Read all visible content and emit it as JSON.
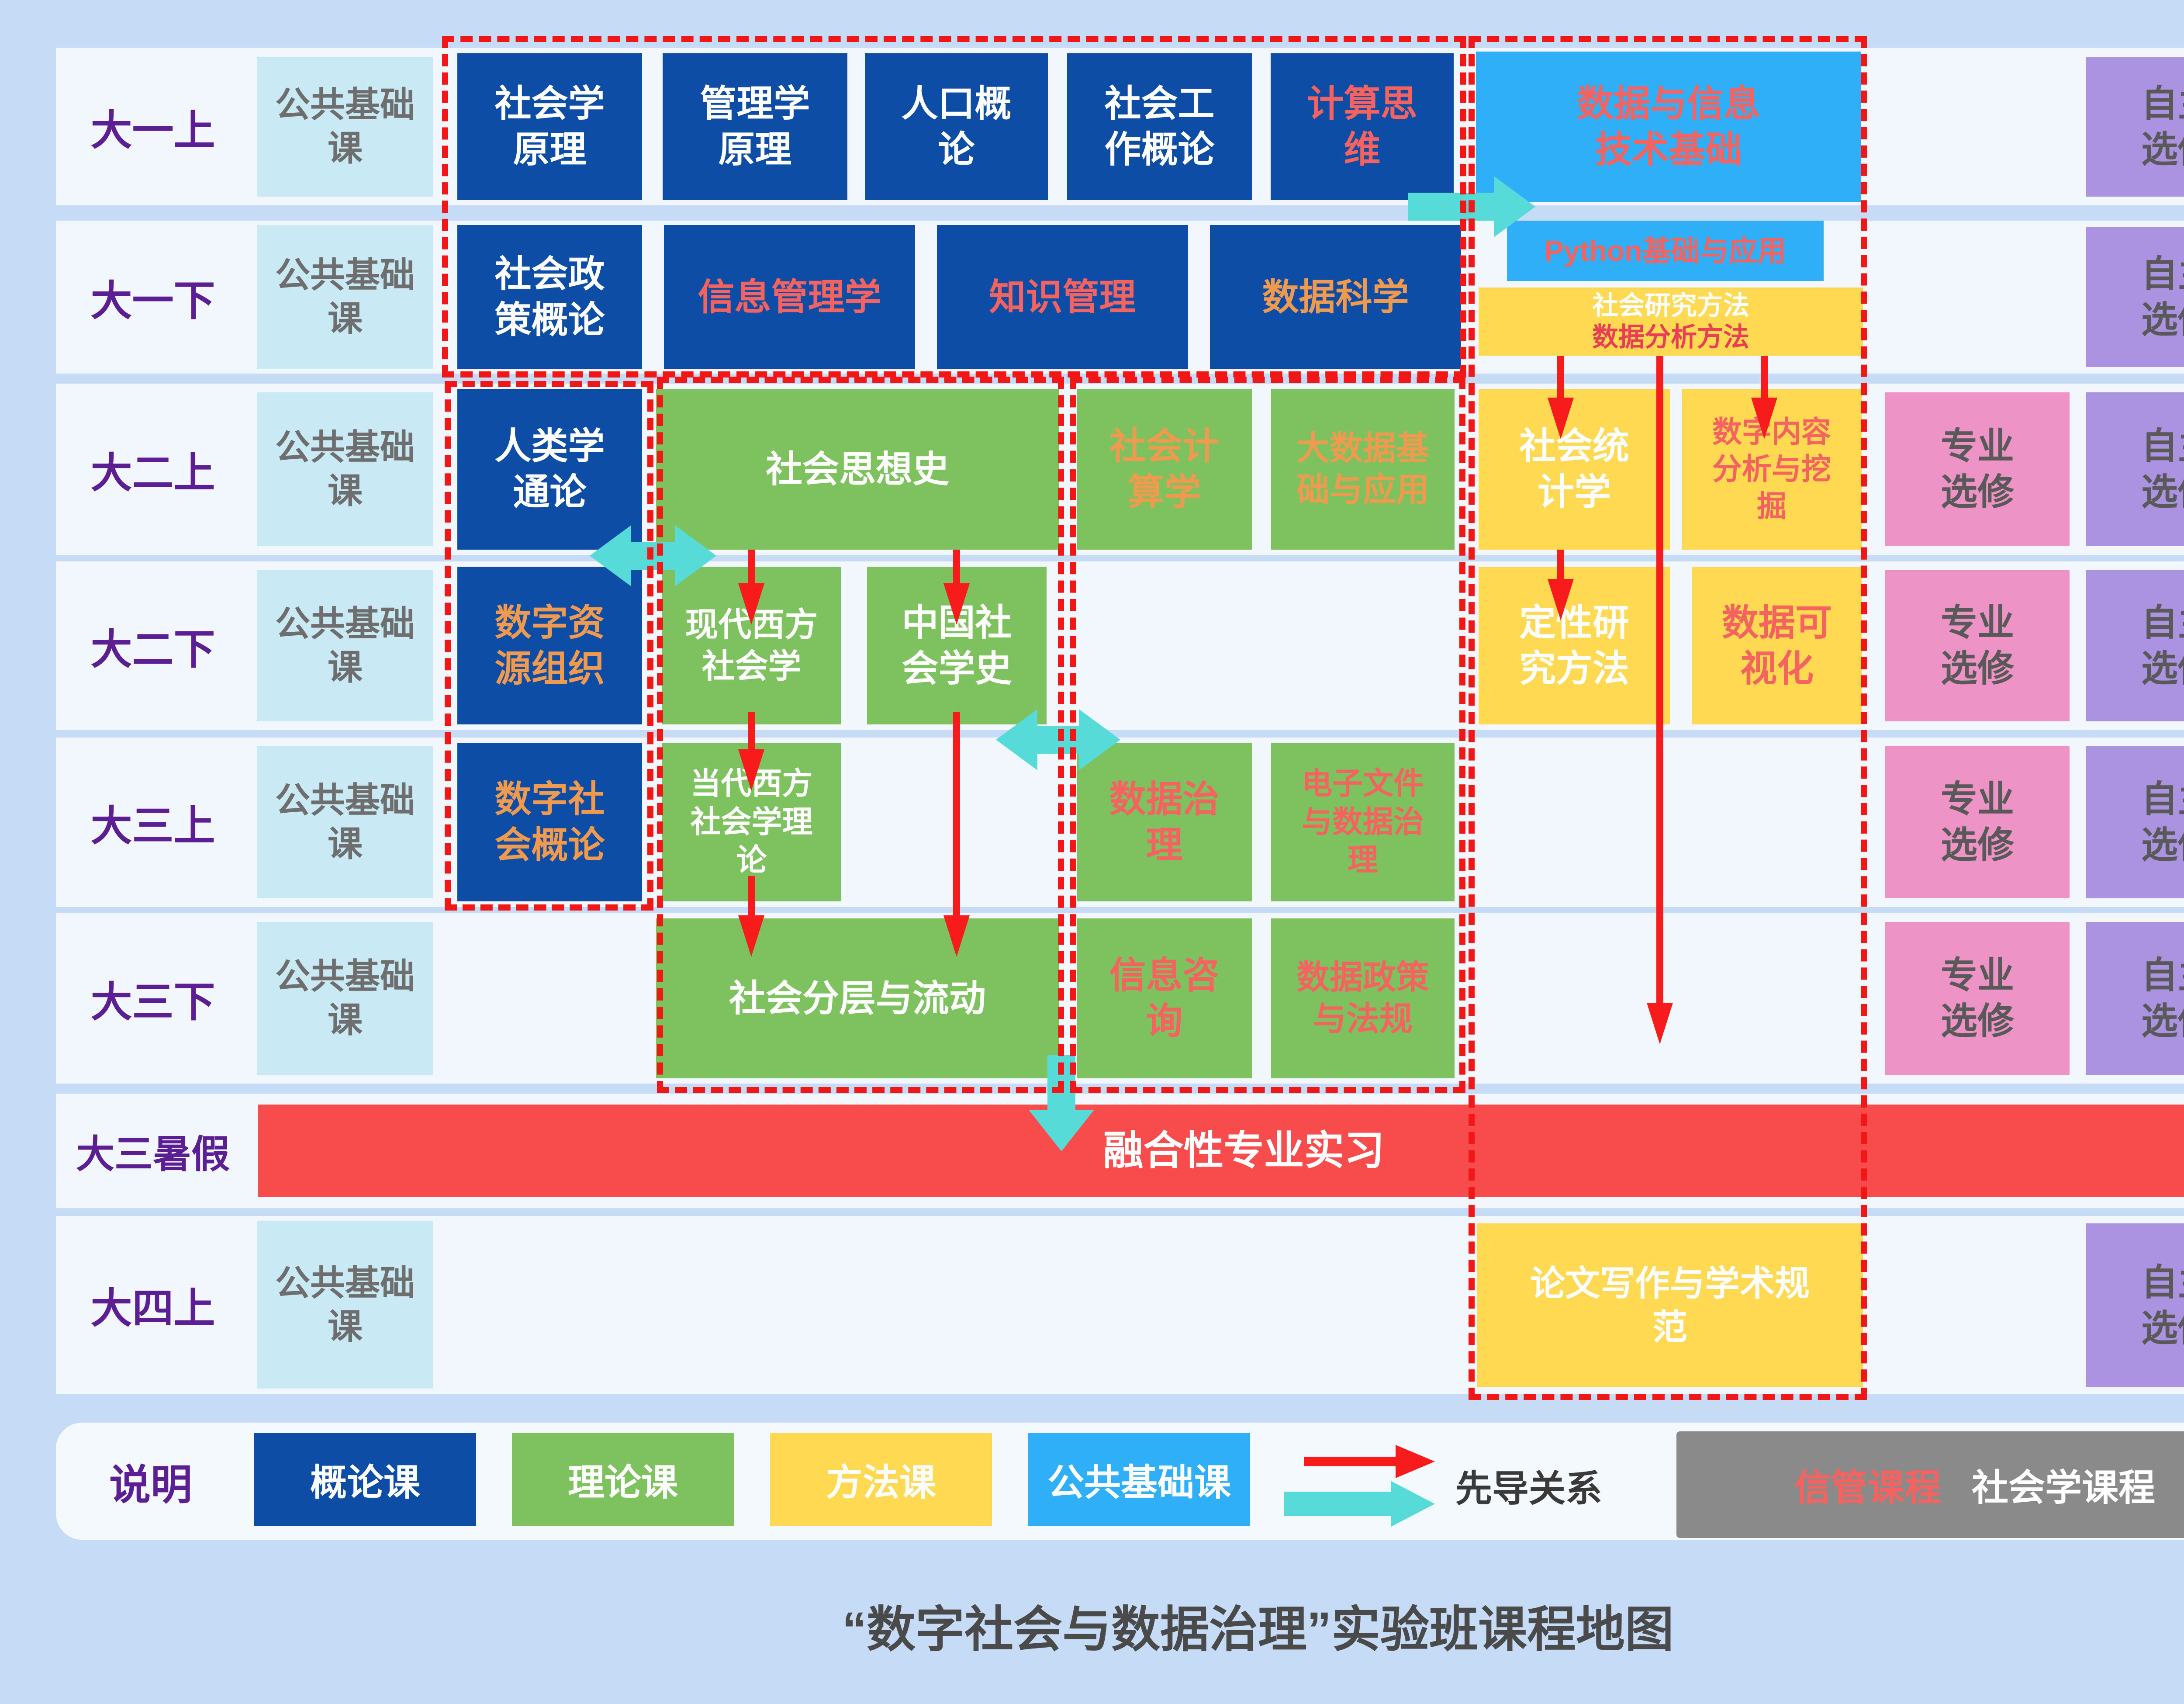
{
  "title": "“数字社会与数据治理”实验班课程地图",
  "semesters": {
    "y1s1": "大一上",
    "y1s2": "大一下",
    "y2s1": "大二上",
    "y2s2": "大二下",
    "y3s1": "大三上",
    "y3s2": "大三下",
    "y3summer": "大三暑假",
    "y4s1": "大四上"
  },
  "shared": {
    "public_base": "公共基础\n课",
    "major_elective": "专业\n选修",
    "free_elective": "自主\n选修"
  },
  "courses": {
    "sociology_principles": {
      "label": "社会学\n原理"
    },
    "management_principles": {
      "label": "管理学\n原理"
    },
    "population_overview": {
      "label": "人口概\n论"
    },
    "social_work_overview": {
      "label": "社会工\n作概论"
    },
    "computational_thinking": {
      "label": "计算思\n维"
    },
    "data_info_tech": {
      "label": "数据与信息\n技术基础"
    },
    "social_policy": {
      "label": "社会政\n策概论"
    },
    "info_management": {
      "label": "信息管理学"
    },
    "knowledge_management": {
      "label": "知识管理"
    },
    "data_science": {
      "label": "数据科学"
    },
    "python_basics": {
      "label": "Python基础与应用"
    },
    "research_methods": {
      "line1": "社会研究方法",
      "line2": "数据分析方法"
    },
    "anthropology": {
      "label": "人类学\n通论"
    },
    "social_thought_history": {
      "label": "社会思想史"
    },
    "social_computing": {
      "label": "社会计\n算学"
    },
    "big_data_foundation": {
      "label": "大数据基\n础与应用"
    },
    "social_statistics": {
      "label": "社会统\n计学"
    },
    "digital_content_mining": {
      "label": "数字内容\n分析与挖\n掘"
    },
    "digital_resource_org": {
      "label": "数字资\n源组织"
    },
    "modern_western_sociology": {
      "label": "现代西方\n社会学"
    },
    "chinese_sociology_history": {
      "label": "中国社\n会学史"
    },
    "qualitative_methods": {
      "label": "定性研\n究方法"
    },
    "data_visualization": {
      "label": "数据可\n视化"
    },
    "digital_society_overview": {
      "label": "数字社\n会概论"
    },
    "contemporary_western_theory": {
      "label": "当代西方\n社会学理\n论"
    },
    "data_governance": {
      "label": "数据治\n理"
    },
    "electronic_records": {
      "label": "电子文件\n与数据治\n理"
    },
    "social_stratification": {
      "label": "社会分层与流动"
    },
    "info_consulting": {
      "label": "信息咨\n询"
    },
    "data_policy_law": {
      "label": "数据政策\n与法规"
    },
    "internship": {
      "label": "融合性专业实习"
    },
    "thesis_writing": {
      "label": "论文写作与学术规\n范"
    }
  },
  "banners": {
    "second_classroom": "实验班第二课堂系列活动",
    "phd_lead": "直博生\n先导\n活动"
  },
  "legend": {
    "heading": "说明",
    "intro": "概论课",
    "theory": "理论课",
    "method": "方法课",
    "public_base": "公共基础课",
    "prereq_label": "先导关系",
    "im_courses": "信管课程",
    "soc_courses": "社会学课程",
    "fusion_courses": "融合课程"
  },
  "colors": {
    "intro_course": "#0d4da6",
    "theory_course": "#7ec15f",
    "method_course": "#ffd951",
    "public_base": "#c9e9f5",
    "info_tech_blue": "#2faff7",
    "major_elective": "#ee93c6",
    "free_elective": "#ac93e2",
    "banner_red": "#f84c4c",
    "arrow_red": "#f71b1b",
    "arrow_cyan": "#57dbd9",
    "salmon_text": "#f4635f",
    "orange_text": "#f09a4f",
    "crimson_text": "#e83e56",
    "semester_purple": "#5c1f93",
    "legend_gray": "#8a8a8a"
  }
}
